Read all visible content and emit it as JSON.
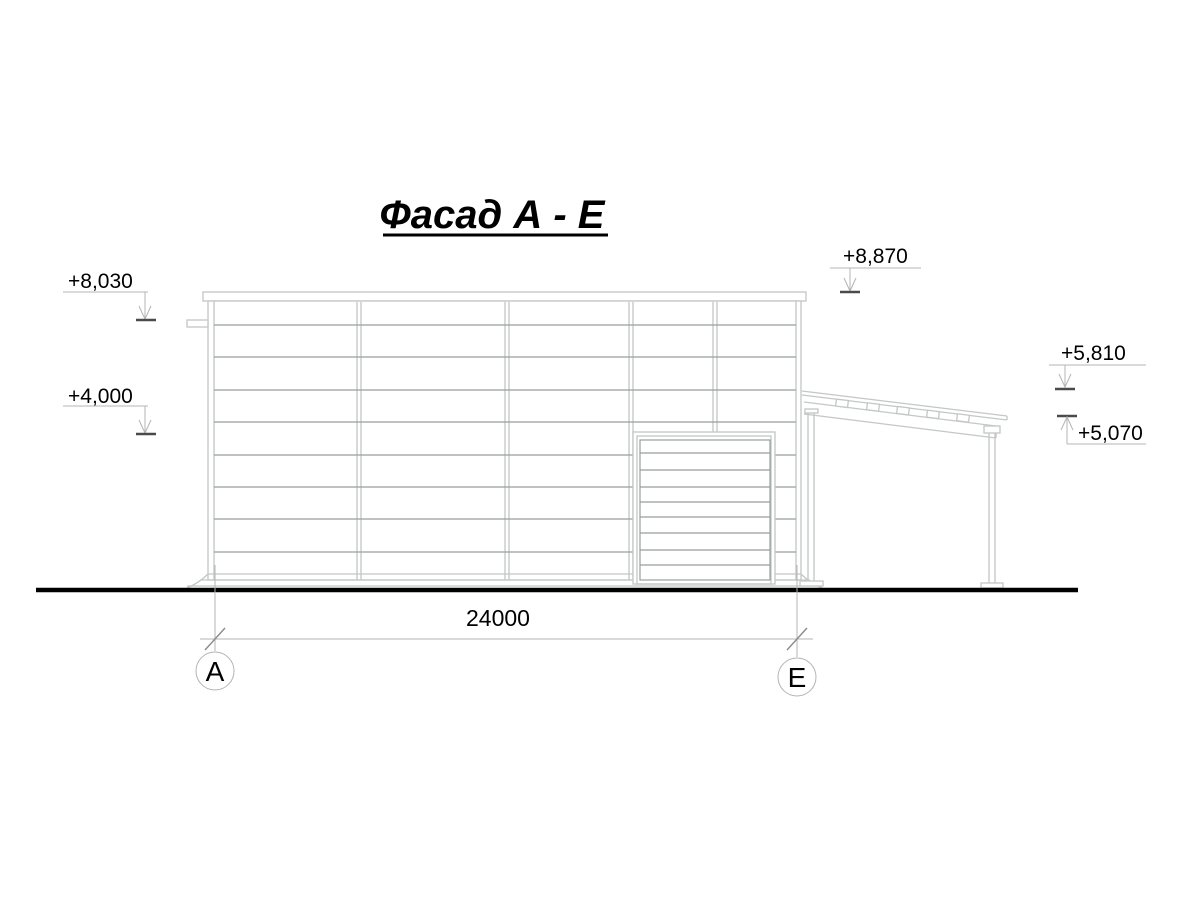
{
  "drawing_title": "Фасад А - Е",
  "elevation_marks": [
    {
      "id": "parapet-left",
      "value": "+8,030"
    },
    {
      "id": "mid-left",
      "value": "+4,000"
    },
    {
      "id": "parapet-right",
      "value": "+8,870"
    },
    {
      "id": "canopy-high",
      "value": "+5,810"
    },
    {
      "id": "canopy-low",
      "value": "+5,070"
    }
  ],
  "dimension": {
    "value": "24000"
  },
  "axes": [
    {
      "id": "A",
      "label": "А"
    },
    {
      "id": "E",
      "label": "Е"
    }
  ],
  "colors": {
    "background": "#ffffff",
    "line_light": "#c4c7c7",
    "line_medium": "#989e9e",
    "leader": "#b4b4b4",
    "level_dash": "#4a4a4a",
    "ground": "#000000",
    "text": "#000000"
  }
}
